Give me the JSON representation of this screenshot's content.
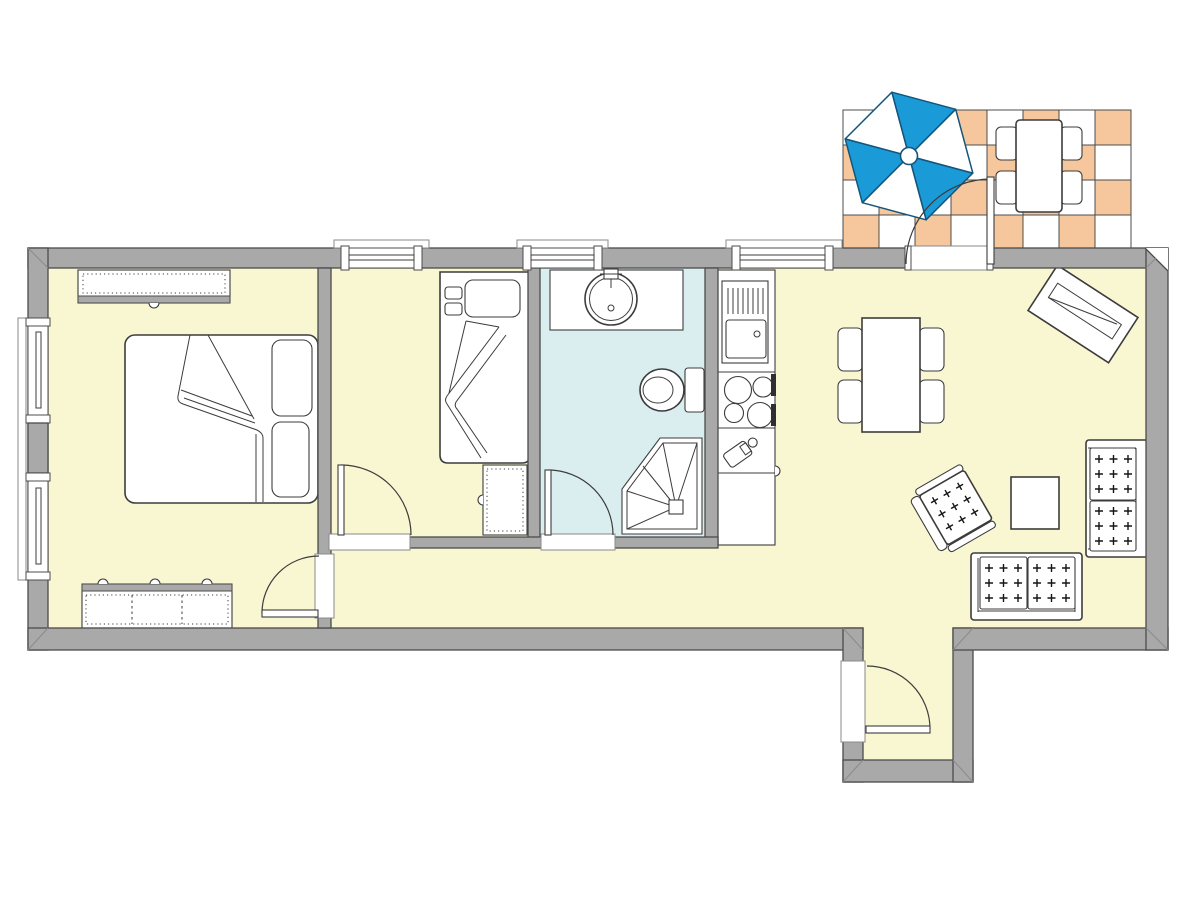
{
  "meta": {
    "artifact": "apartment-floor-plan",
    "view": "2d-top-down-architectural-drawing",
    "visible_text": []
  },
  "colors": {
    "background": "#ffffff",
    "wall": "#a9a9a9",
    "wall_outline": "#4c4c4c",
    "floor_main": "#f9f6d2",
    "floor_bath": "#daeef0",
    "tile_orange": "#f6c79d",
    "tile_white": "#ffffff",
    "tile_line": "#4c4c4c",
    "umbrella_blue": "#1a9bd7",
    "umbrella_line": "#14557c",
    "line": "#3c3c3c",
    "mark": "#161616",
    "miter": "#8c8c8c",
    "appliance_dark": "#2f2f2f"
  },
  "terrace": {
    "tiles": {
      "rows": 4,
      "cols": 8,
      "pattern": "checkerboard",
      "colors": [
        "tile_white",
        "tile_orange"
      ],
      "outline": "tile_line"
    },
    "umbrella": {
      "segments": 6,
      "alternating": [
        "umbrella_blue",
        "tile_white"
      ]
    },
    "items": [
      "patio-umbrella",
      "patio-table",
      "patio-chair",
      "patio-chair",
      "patio-chair",
      "patio-chair",
      "terrace-door"
    ]
  },
  "rooms": [
    {
      "id": "bedroom-main",
      "floor": "floor_main",
      "items": [
        "wardrobe-top",
        "double-bed",
        "pillow",
        "pillow",
        "wardrobe-bottom",
        "interior-door",
        "window",
        "window"
      ]
    },
    {
      "id": "bedroom-small",
      "floor": "floor_main",
      "items": [
        "single-bed",
        "pillow",
        "nightstand",
        "interior-door",
        "window"
      ]
    },
    {
      "id": "bathroom",
      "floor": "floor_bath",
      "items": [
        "vanity-counter",
        "round-sink",
        "toilet",
        "corner-shower",
        "interior-door",
        "window"
      ]
    },
    {
      "id": "kitchen",
      "floor": "floor_main",
      "items": [
        "tall-appliance-unit",
        "cooktop-4-burners",
        "small-appliance",
        "base-cabinet",
        "window"
      ]
    },
    {
      "id": "living-room",
      "floor": "floor_main",
      "items": [
        "dining-table",
        "dining-chair",
        "dining-chair",
        "dining-chair",
        "dining-chair",
        "sideboard-angled",
        "sofa-two-seat",
        "sofa-two-seat",
        "armchair",
        "coffee-table"
      ]
    },
    {
      "id": "entry-vestibule",
      "floor": "floor_main",
      "items": [
        "entry-door"
      ]
    }
  ]
}
